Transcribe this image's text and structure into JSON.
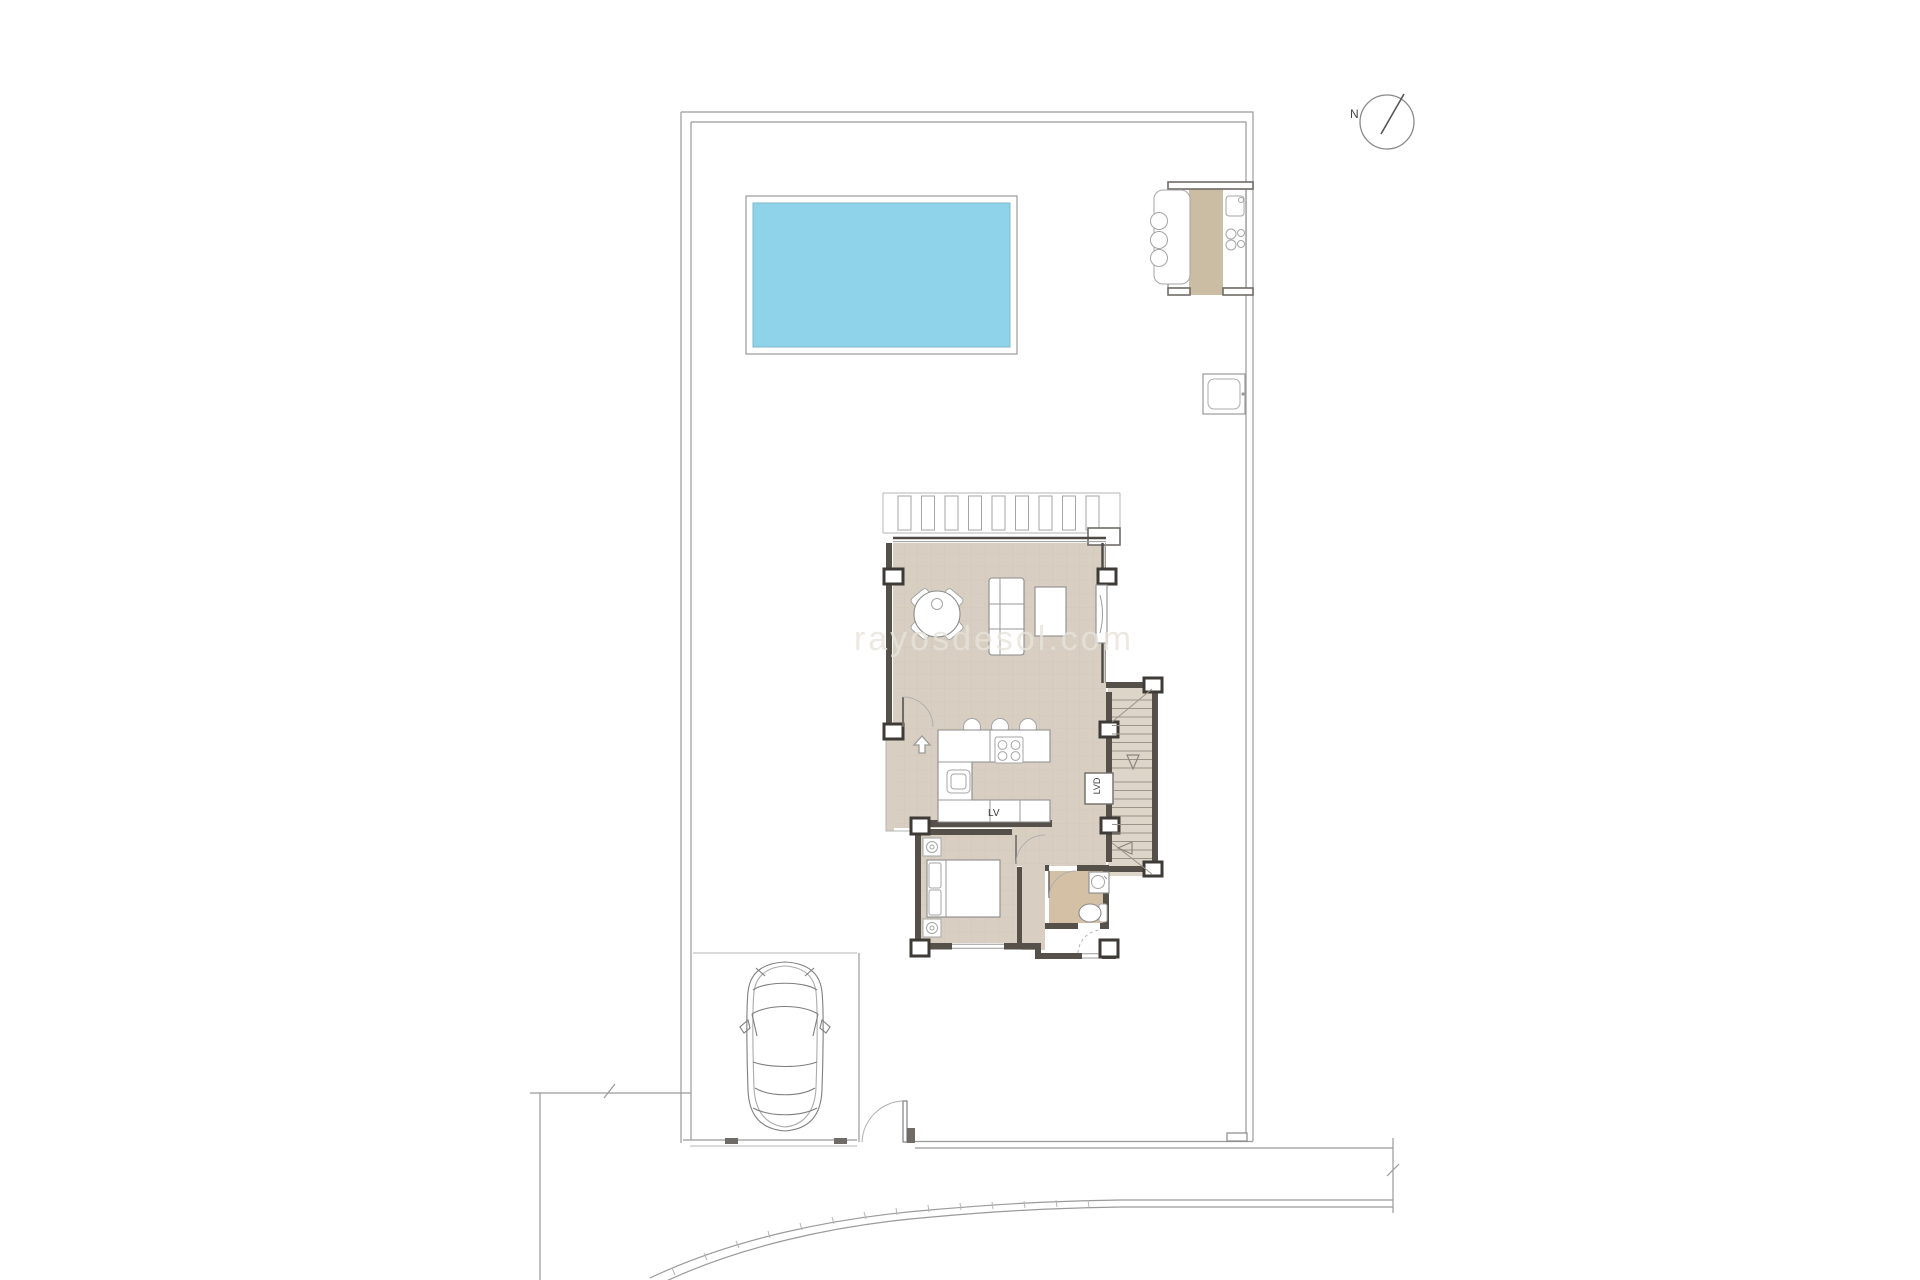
{
  "plan": {
    "type": "architectural-site-and-floor-plan",
    "watermark": "rayosdesol.com",
    "north_label": "N",
    "labels": {
      "dishwasher": "LV",
      "laundry_closet": "LVD"
    },
    "features": [
      "property-boundary",
      "swimming-pool",
      "outdoor-kitchen-bbq",
      "north-indicator",
      "pergola",
      "living-dining-room",
      "kitchen-island",
      "staircase",
      "laundry-closet",
      "bedroom",
      "bathroom",
      "entry-porch",
      "carport-with-car",
      "pedestrian-gate",
      "street-curb",
      "equipment-box"
    ],
    "colors": {
      "pool_water": "#8fd3ea",
      "pool_edge": "#7fb7c9",
      "floor_beige": "#d8cfc2",
      "floor_grid": "#beb3a3",
      "stairs_floor": "#ddd5c8",
      "bath_floor": "#d4c0a4",
      "outdoor_tan": "#cbbda4",
      "wall_dark": "#55504a",
      "line_gray": "#9a9a9a",
      "watermark_color": "#e8e4db"
    }
  }
}
